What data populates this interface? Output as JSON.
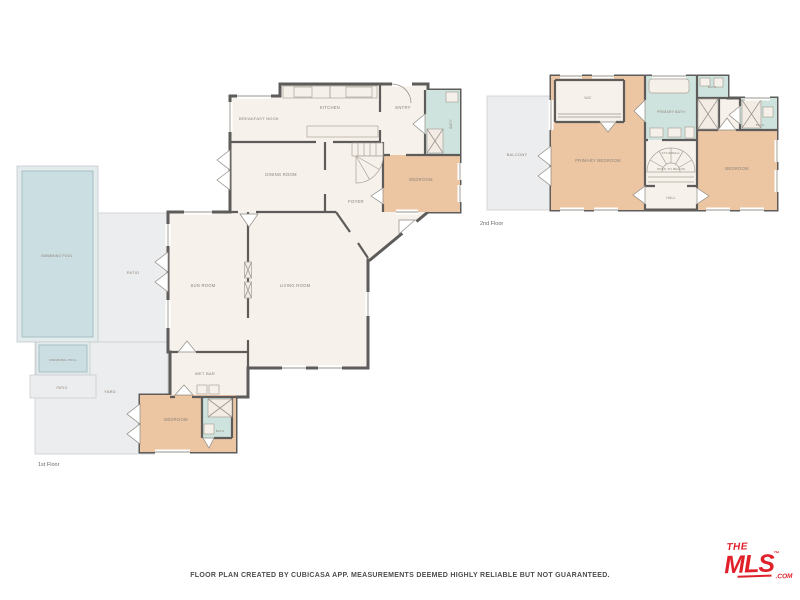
{
  "colors": {
    "wall": "#5d5c5b",
    "room": "#f7f1eb",
    "bedroom": "#ecc5a2",
    "bath": "#cfe3de",
    "outdoor": "#ecedee",
    "pool": "#cbdee2",
    "label": "#8b8277",
    "logo_red": "#e0212a"
  },
  "footer": {
    "disclaimer": "FLOOR PLAN CREATED BY CUBICASA APP. MEASUREMENTS DEEMED HIGHLY RELIABLE BUT NOT GUARANTEED."
  },
  "logo": {
    "the": "THE",
    "mls": "MLS",
    "tm": "™",
    "com": ".COM"
  },
  "floor1": {
    "label": "1st Floor",
    "rooms": {
      "swimming_pool": "SWIMMING POOL",
      "patio": "PATIO",
      "swimming_pool_small": "SWIMMING POOL",
      "patio_small": "PATIO",
      "yard": "YARD",
      "breakfast_nook": "BREAKFAST NOOK",
      "kitchen": "KITCHEN",
      "entry": "ENTRY",
      "bath": "BATH",
      "dining_room": "DINING ROOM",
      "foyer": "FOYER",
      "bedroom": "BEDROOM",
      "sun_room": "SUN ROOM",
      "living_room": "LIVING ROOM",
      "wet_bar": "WET BAR",
      "bedroom2": "BEDROOM",
      "bath2": "BATH"
    }
  },
  "floor2": {
    "label": "2nd Floor",
    "rooms": {
      "balcony": "BALCONY",
      "wic": "WIC",
      "primary_bedroom": "PRIMARY BEDROOM",
      "primary_bath": "PRIMARY BATH",
      "bath_top": "BATH",
      "bath_right": "BATH",
      "bedroom": "BEDROOM",
      "stairwell": "STAIRWELL",
      "open_to_below": "OPEN TO BELOW",
      "hall": "HALL"
    }
  }
}
